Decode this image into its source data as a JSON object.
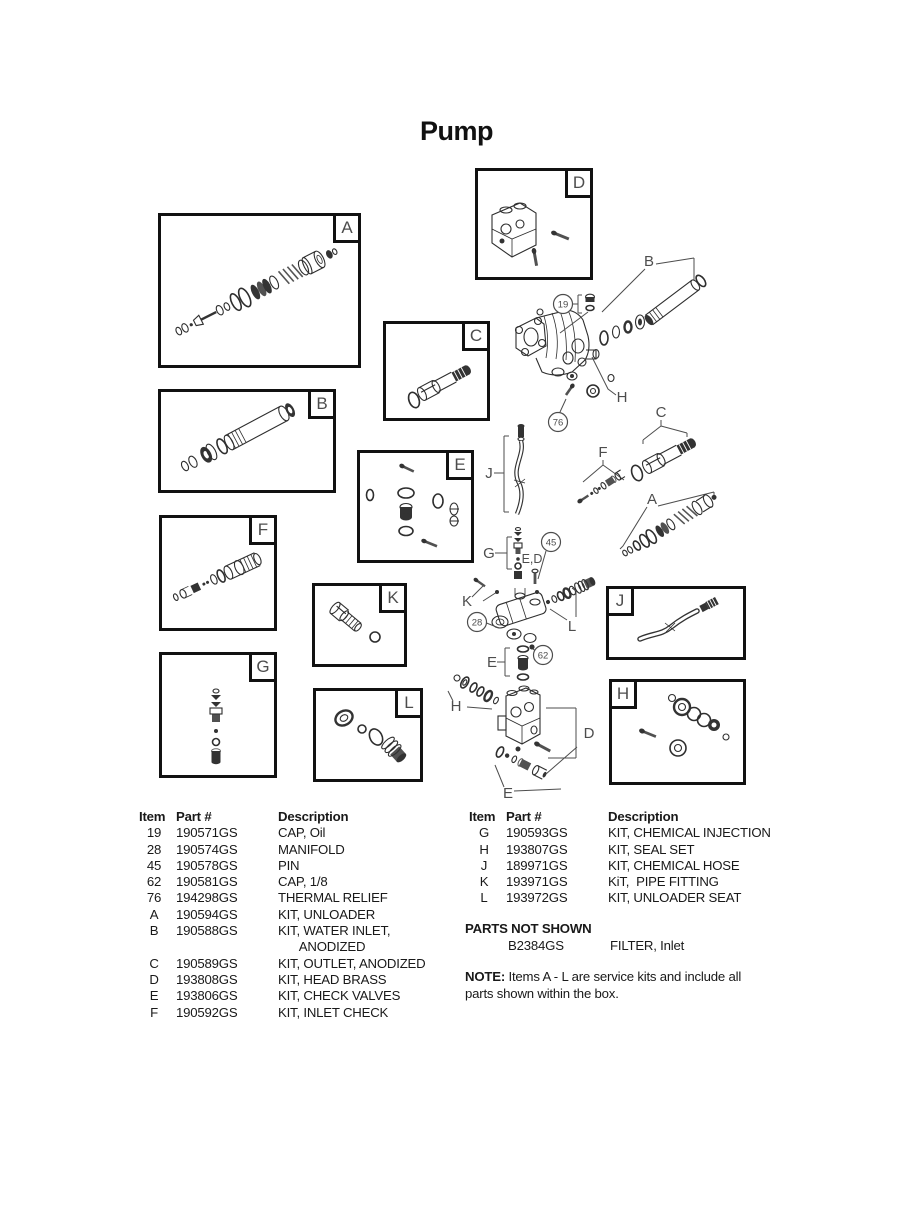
{
  "page": {
    "title": "Pump"
  },
  "diagram": {
    "boxes": {
      "a": "A",
      "b": "B",
      "c": "C",
      "d": "D",
      "e": "E",
      "f": "F",
      "g": "G",
      "h": "H",
      "j": "J",
      "k": "K",
      "l": "L"
    },
    "callouts": {
      "c19": "19",
      "c28": "28",
      "c45": "45",
      "c62": "62",
      "c76": "76"
    },
    "refs": {
      "b": "B",
      "h_top": "H",
      "c": "C",
      "f": "F",
      "a": "A",
      "j": "J",
      "g": "G",
      "ed": "E,D",
      "k": "K",
      "l": "L",
      "e_mid": "E",
      "h_low": "H",
      "d": "D",
      "e_low": "E"
    }
  },
  "parts_list": {
    "headers": {
      "item": "Item",
      "part": "Part #",
      "desc": "Description"
    },
    "left_rows": [
      {
        "item": "19",
        "part": "190571GS",
        "desc": "CAP, Oil"
      },
      {
        "item": "28",
        "part": "190574GS",
        "desc": "MANIFOLD"
      },
      {
        "item": "45",
        "part": "190578GS",
        "desc": "PIN"
      },
      {
        "item": "62",
        "part": "190581GS",
        "desc": "CAP, 1/8"
      },
      {
        "item": "76",
        "part": "194298GS",
        "desc": "THERMAL RELIEF"
      },
      {
        "item": "A",
        "part": "190594GS",
        "desc": "KIT, UNLOADER"
      },
      {
        "item": "B",
        "part": "190588GS",
        "desc": "KIT, WATER INLET,\n      ANODIZED"
      },
      {
        "item": "C",
        "part": "190589GS",
        "desc": "KIT, OUTLET, ANODIZED"
      },
      {
        "item": "D",
        "part": "193808GS",
        "desc": "KIT, HEAD BRASS"
      },
      {
        "item": "E",
        "part": "193806GS",
        "desc": "KIT, CHECK VALVES"
      },
      {
        "item": "F",
        "part": "190592GS",
        "desc": "KIT, INLET CHECK"
      }
    ],
    "right_rows": [
      {
        "item": "G",
        "part": "190593GS",
        "desc": "KIT, CHEMICAL INJECTION"
      },
      {
        "item": "H",
        "part": "193807GS",
        "desc": "KIT, SEAL SET"
      },
      {
        "item": "J",
        "part": "189971GS",
        "desc": "KIT, CHEMICAL HOSE"
      },
      {
        "item": "K",
        "part": "193971GS",
        "desc": "KiT,  PIPE FITTING"
      },
      {
        "item": "L",
        "part": "193972GS",
        "desc": "KIT, UNLOADER SEAT"
      }
    ],
    "not_shown": {
      "title": "PARTS NOT SHOWN",
      "part": "B2384GS",
      "desc": "FILTER, Inlet"
    },
    "note": {
      "label": "NOTE:",
      "text": " Items A - L are service kits and include all parts shown within the box."
    }
  }
}
